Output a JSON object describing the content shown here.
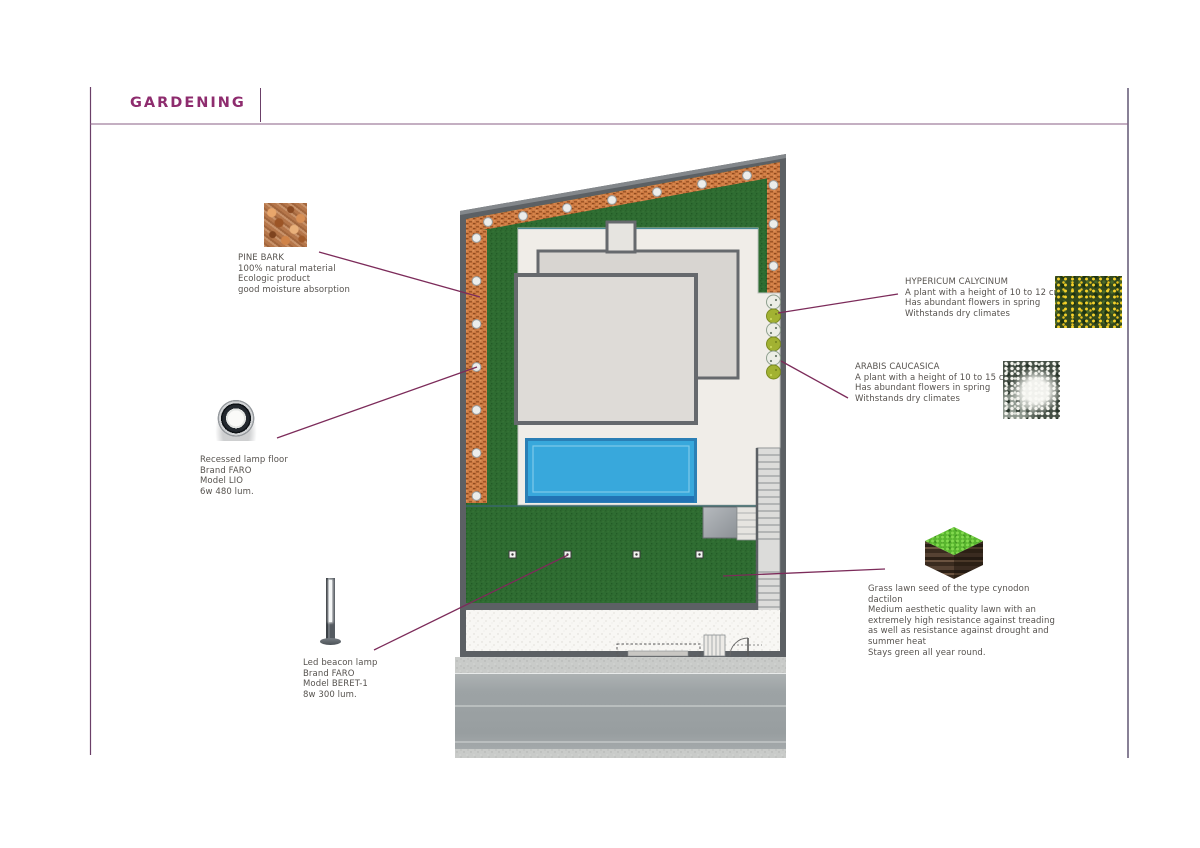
{
  "page": {
    "title": "GARDENING"
  },
  "colors": {
    "accent": "#8e2c6e",
    "leader": "#7c2b5a",
    "frame": "#7b4a77",
    "wall": "#5c6064",
    "terrace": "#f0ede8",
    "roof_upper": "#d8d5d1",
    "roof_main": "#dedbd7",
    "roof_border": "#66696d",
    "pool_water": "#38a8dc",
    "pool_frame": "#2b7fb5",
    "pool_deep": "#2273b4",
    "platform": "#9aa0a6",
    "plant_yellow": "#a2b232",
    "plant_white": "#eceee6"
  },
  "annotations": {
    "pine_bark": {
      "title": "PINE BARK",
      "lines": [
        "100% natural material",
        "Ecologic product",
        "good moisture absorption"
      ]
    },
    "recessed_lamp": {
      "lines": [
        "Recessed lamp floor",
        "Brand FARO",
        "Model LIO",
        "6w 480 lum."
      ]
    },
    "led_beacon": {
      "lines": [
        "Led beacon lamp",
        "Brand FARO",
        "Model BERET-1",
        "8w 300 lum."
      ]
    },
    "hypericum": {
      "title": "HYPERICUM CALYCINUM",
      "lines": [
        "A plant with a height of 10 to 12 cm",
        "Has abundant flowers in spring",
        "Withstands dry climates"
      ]
    },
    "arabis": {
      "title": "ARABIS CAUCASICA",
      "lines": [
        "A plant with a height of 10 to 15 cm",
        "Has abundant flowers in spring",
        "Withstands dry climates"
      ]
    },
    "grass": {
      "lines": [
        "Grass lawn seed of the type cynodon dactilon",
        "Medium aesthetic quality lawn with an",
        "extremely high resistance against treading",
        "as well as resistance against drought and",
        "summer heat",
        "Stays green all year round."
      ]
    }
  }
}
